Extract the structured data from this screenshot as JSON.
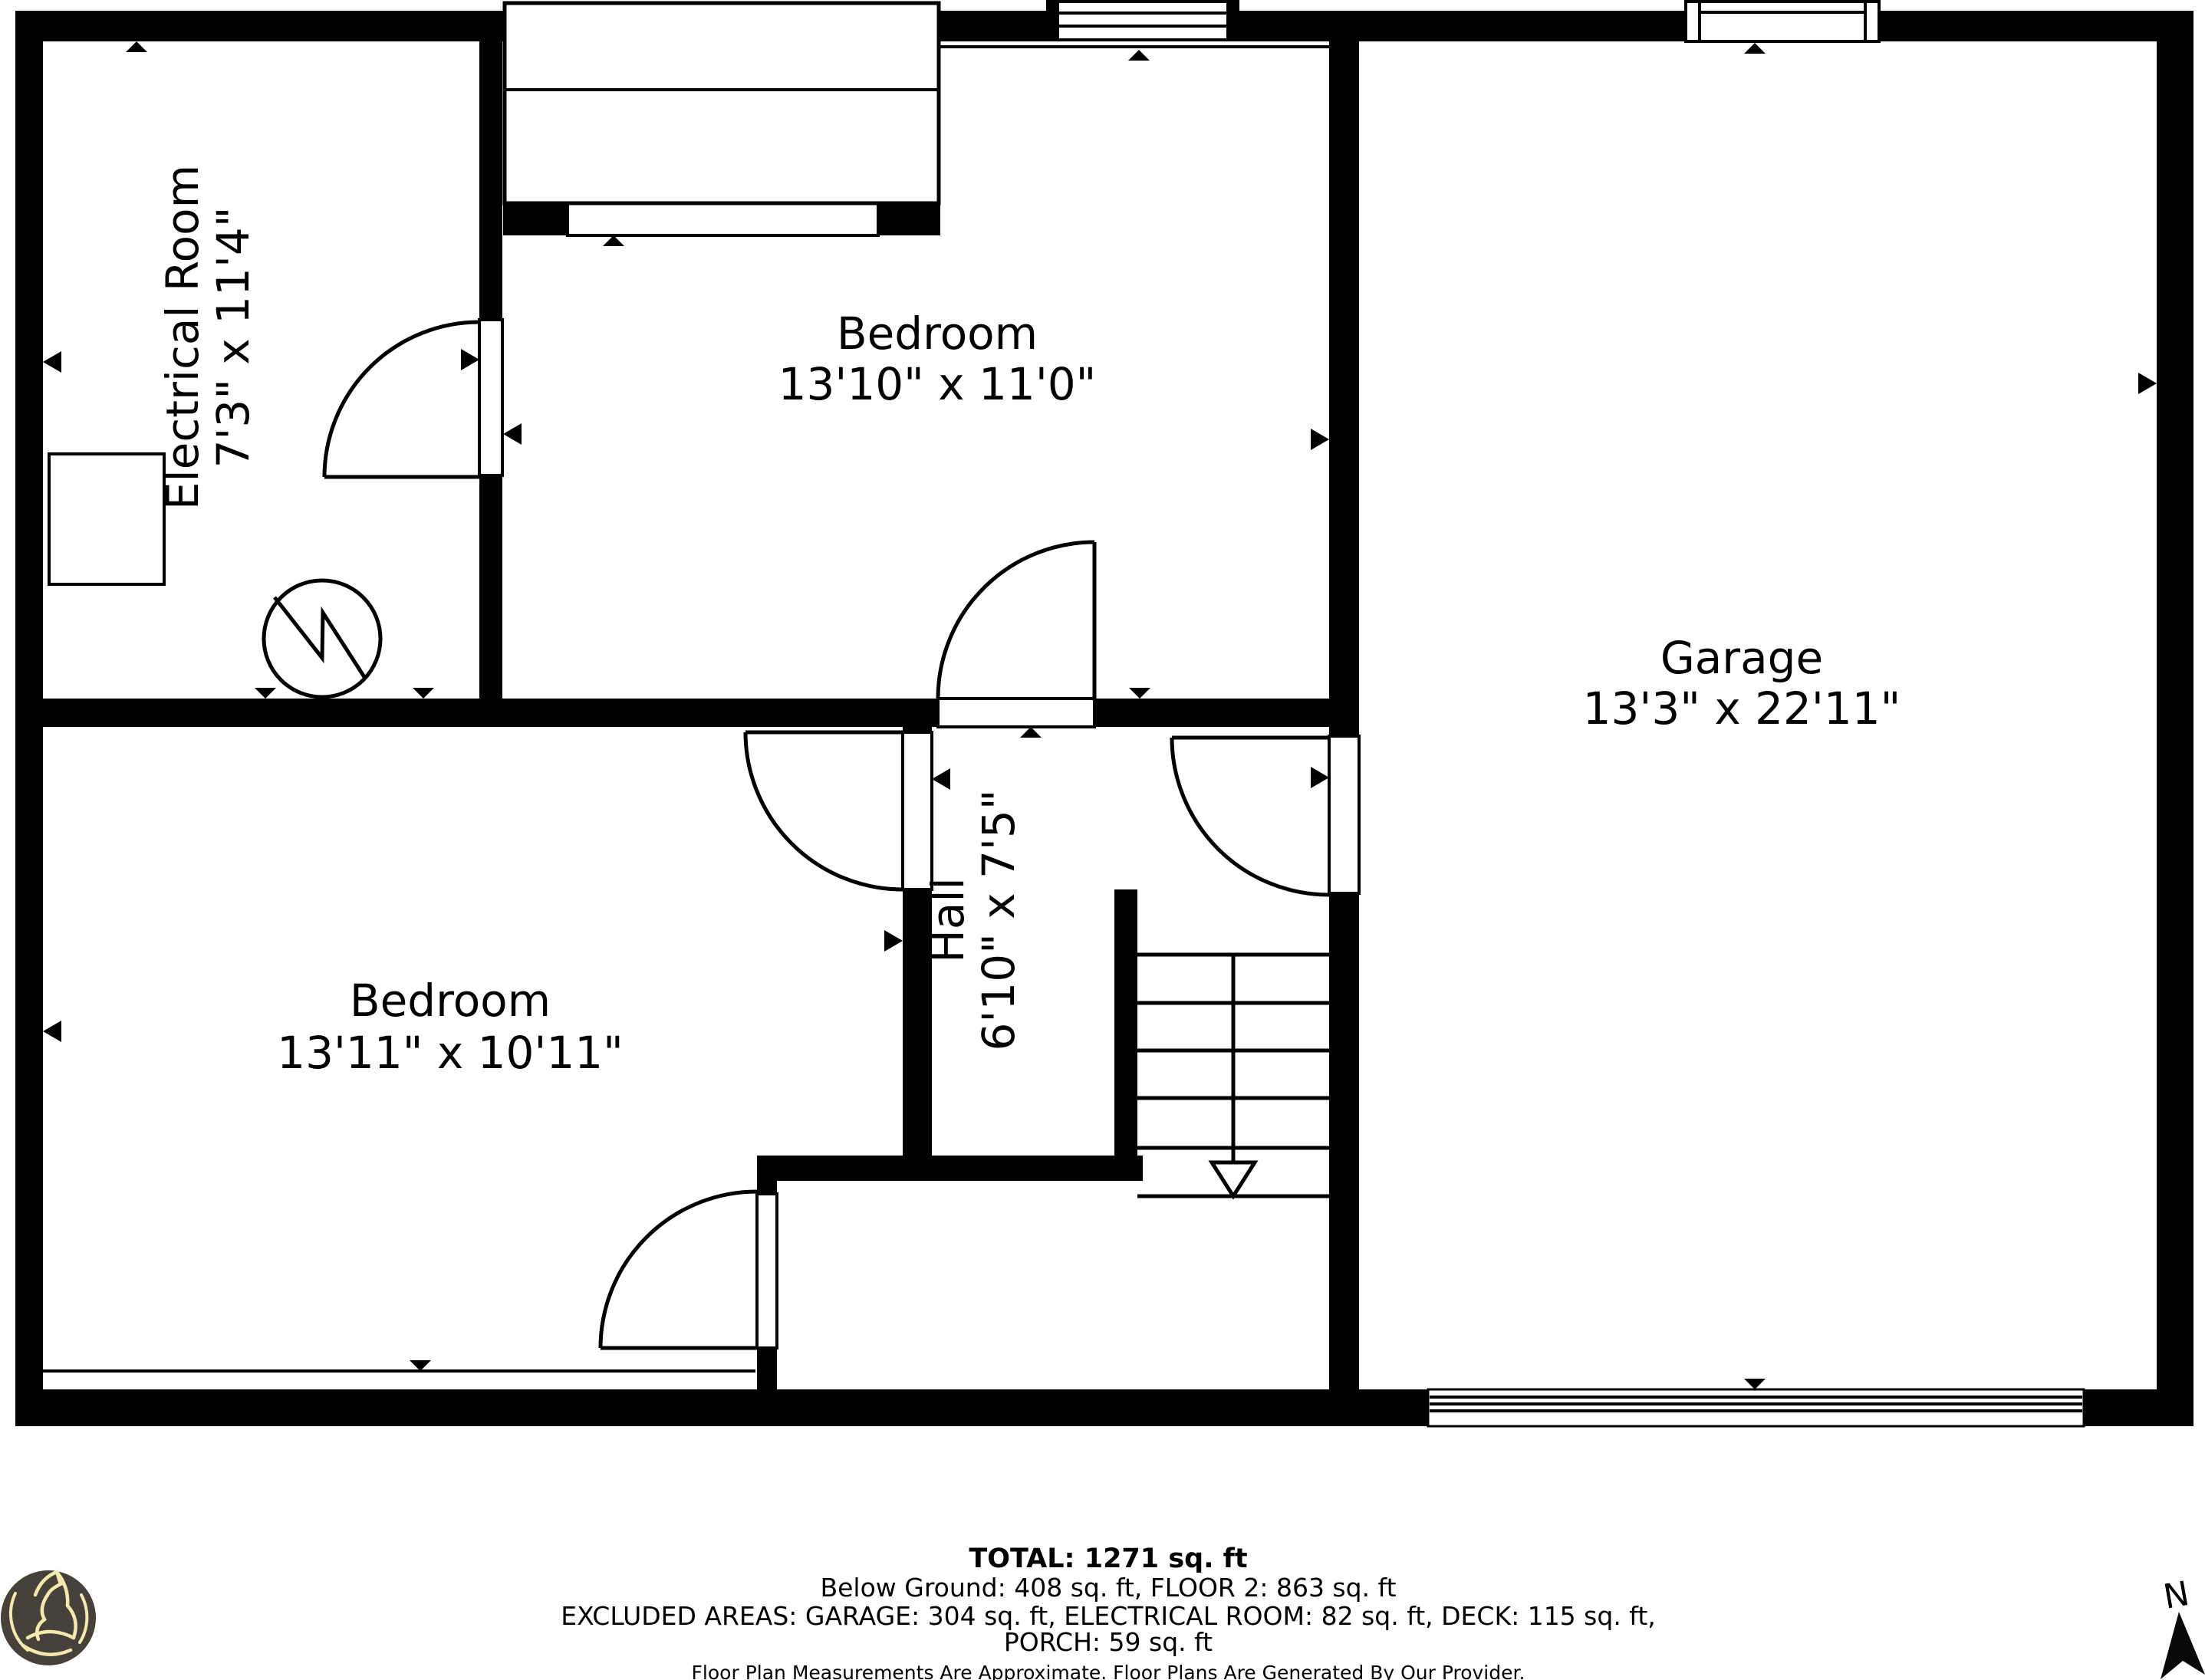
{
  "plan": {
    "background_color": "#ffffff",
    "wall_color": "#000000",
    "rooms": {
      "electrical": {
        "name": "Electrical Room",
        "dims": "7'3\" x 11'4\""
      },
      "bedroom_top": {
        "name": "Bedroom",
        "dims": "13'10\" x 11'0\""
      },
      "garage": {
        "name": "Garage",
        "dims": "13'3\" x 22'11\""
      },
      "bedroom_left": {
        "name": "Bedroom",
        "dims": "13'11\" x 10'11\""
      },
      "hall": {
        "name": "Hall",
        "dims": "6'10\" x 7'5\""
      }
    }
  },
  "footer": {
    "total": "TOTAL: 1271 sq. ft",
    "breakdown": "Below Ground: 408 sq. ft, FLOOR 2: 863 sq. ft",
    "excluded_line1": "EXCLUDED AREAS: GARAGE: 304 sq. ft, ELECTRICAL ROOM: 82 sq. ft, DECK: 115 sq. ft,",
    "excluded_line2": "PORCH: 59 sq. ft",
    "disclaimer": "Floor Plan Measurements Are Approximate. Floor Plans Are Generated By Our Provider."
  },
  "compass": {
    "north_label": "N"
  },
  "logo": {
    "shape": "howling-wolf-badge",
    "bg_color": "#46413a",
    "line_color": "#f3e9ad"
  }
}
